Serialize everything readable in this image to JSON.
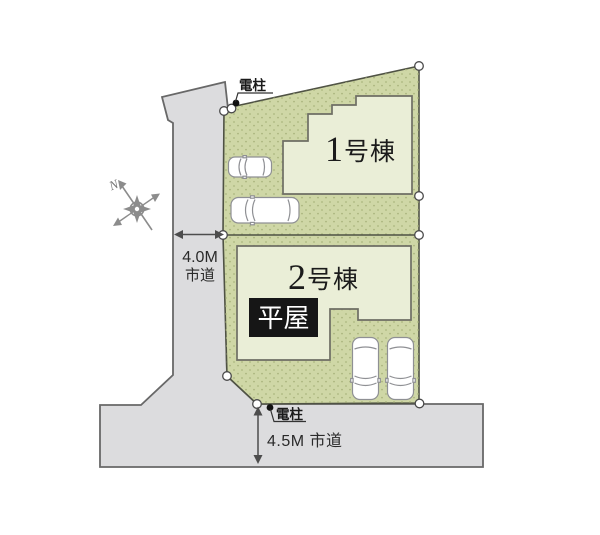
{
  "site_plan": {
    "buildings": [
      {
        "number": "1",
        "suffix": "号棟"
      },
      {
        "number": "2",
        "suffix": "号棟",
        "badge": "平屋"
      }
    ],
    "roads": {
      "west": {
        "width_label": "4.0M",
        "type_label": "市道"
      },
      "south": {
        "label": "4.5M 市道"
      }
    },
    "poles": {
      "top_label": "電柱",
      "bottom_label": "電柱"
    },
    "compass": {
      "north_label": "N"
    },
    "colors": {
      "lot_fill": "#cfd7a6",
      "lot_dot": "#a9b37c",
      "lot_stroke": "#4f5244",
      "building_fill": "#eaeed7",
      "building_stroke": "#6e6e64",
      "road_fill": "#dcdcde",
      "road_stroke": "#686868",
      "badge_bg": "#161616",
      "badge_text": "#ffffff",
      "label_text": "#1b1b1b",
      "dimension": "#4d4d4d",
      "compass": "#8c8c8c",
      "car_fill": "#ffffff",
      "car_stroke": "#8f9094",
      "marker_fill": "#ffffff",
      "marker_stroke": "#4a4a4a",
      "pole_dot": "#111111"
    }
  }
}
